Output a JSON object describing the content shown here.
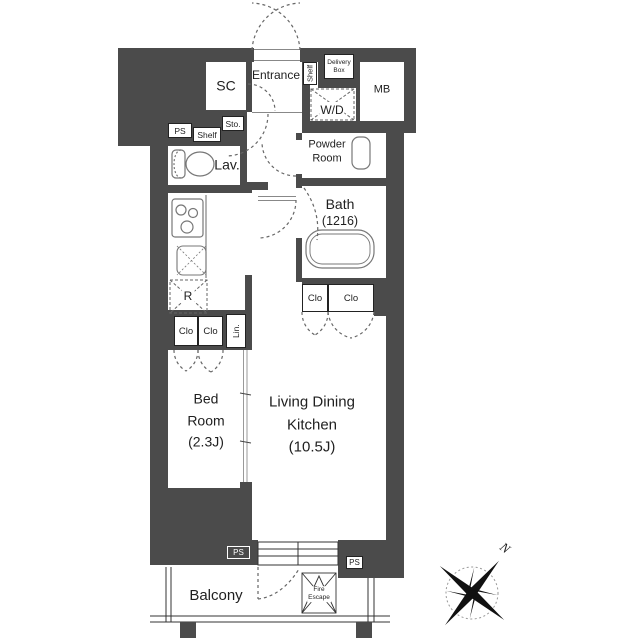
{
  "plan": {
    "type": "apartment-floor-plan",
    "colors": {
      "wall": "#4b4b4b",
      "outline": "#333333",
      "fixture": "#777777",
      "dash": "#666666"
    },
    "rooms": {
      "sc": {
        "label": "SC"
      },
      "entrance": {
        "label": "Entrance"
      },
      "mb": {
        "label": "MB"
      },
      "washer_dryer": {
        "label": "W/D"
      },
      "powder_room": {
        "line1": "Powder",
        "line2": "Room"
      },
      "bath": {
        "line1": "Bath",
        "line2": "(1216)"
      },
      "lavatory": {
        "label": "Lav."
      },
      "bedroom": {
        "line1": "Bed",
        "line2": "Room",
        "line3": "(2.3J)"
      },
      "ldk": {
        "line1": "Living Dining",
        "line2": "Kitchen",
        "line3": "(10.5J)"
      },
      "balcony": {
        "label": "Balcony"
      }
    },
    "labels": {
      "ps_top": "PS",
      "shelf_top": "Shelf",
      "shelf_side": "Shelf",
      "storage": "Sto.",
      "delivery_line1": "Delivery",
      "delivery_line2": "Box",
      "refrigerator": "R",
      "linen": "Lin.",
      "closets": [
        "Clo",
        "Clo",
        "Clo",
        "Clo"
      ],
      "ps_bottom_left": "PS",
      "ps_bottom_right": "PS",
      "fire_escape_line1": "Fire",
      "fire_escape_line2": "Escape",
      "compass_north": "N"
    }
  }
}
